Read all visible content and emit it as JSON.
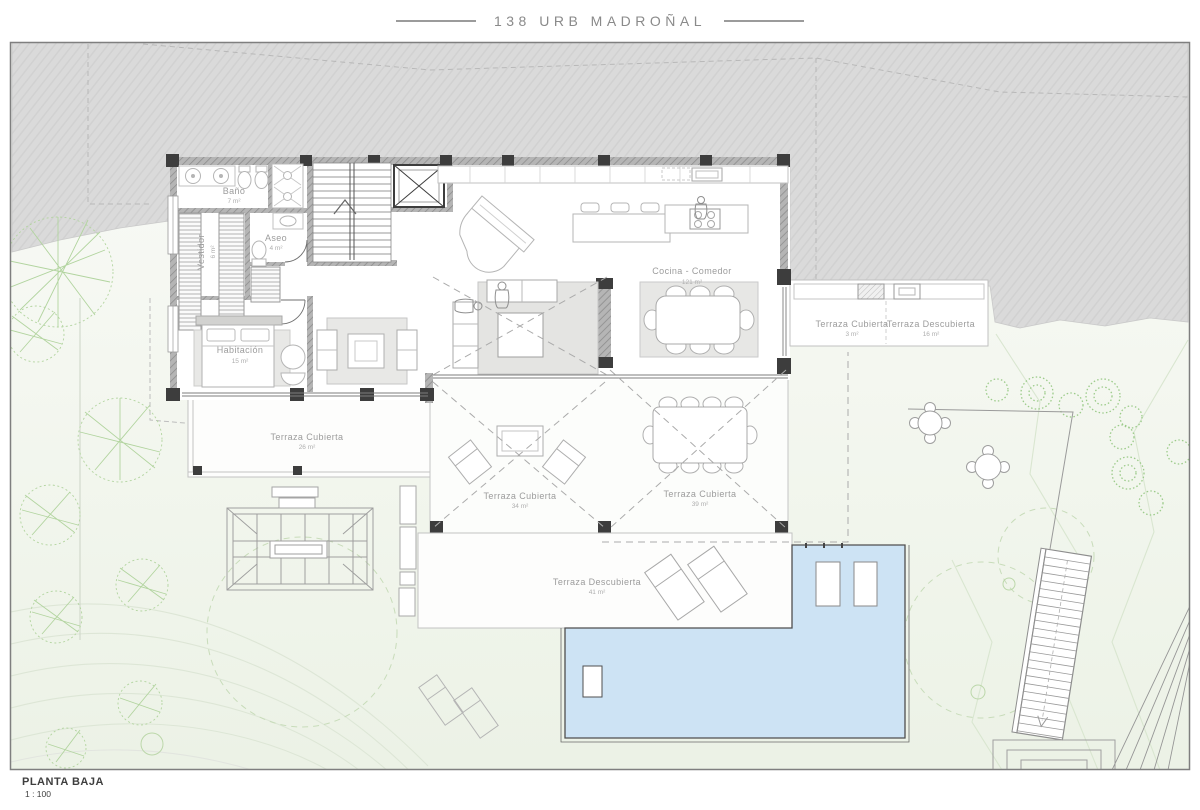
{
  "title": "138 URB MADROÑAL",
  "footer": {
    "plan_name": "PLANTA BAJA",
    "scale": "1 : 100"
  },
  "rooms": [
    {
      "id": "bano",
      "name": "Baño",
      "area": "7 m²"
    },
    {
      "id": "aseo",
      "name": "Aseo",
      "area": "4 m²"
    },
    {
      "id": "vestidor",
      "name": "Vestidor",
      "area": "6 m²"
    },
    {
      "id": "habitacion",
      "name": "Habitación",
      "area": "15 m²"
    },
    {
      "id": "cocina-comedor",
      "name": "Cocina - Comedor",
      "area": "121 m²"
    },
    {
      "id": "terraza-cubierta-3",
      "name": "Terraza Cubierta",
      "area": "3 m²"
    },
    {
      "id": "terraza-descubierta-16",
      "name": "Terraza Descubierta",
      "area": "16 m²"
    },
    {
      "id": "terraza-cubierta-26",
      "name": "Terraza Cubierta",
      "area": "26 m²"
    },
    {
      "id": "terraza-cubierta-34",
      "name": "Terraza Cubierta",
      "area": "34 m²"
    },
    {
      "id": "terraza-cubierta-39",
      "name": "Terraza Cubierta",
      "area": "39 m²"
    },
    {
      "id": "terraza-descubierta-41",
      "name": "Terraza Descubierta",
      "area": "41 m²"
    }
  ],
  "colors": {
    "pool_blue": "#cde3f4",
    "hill_gray": "#dadada",
    "wall_dark": "#3d3d3d",
    "tree_green": "#a9cf97",
    "label_gray": "#9c9c9c",
    "contour_green": "#dce8d4"
  }
}
